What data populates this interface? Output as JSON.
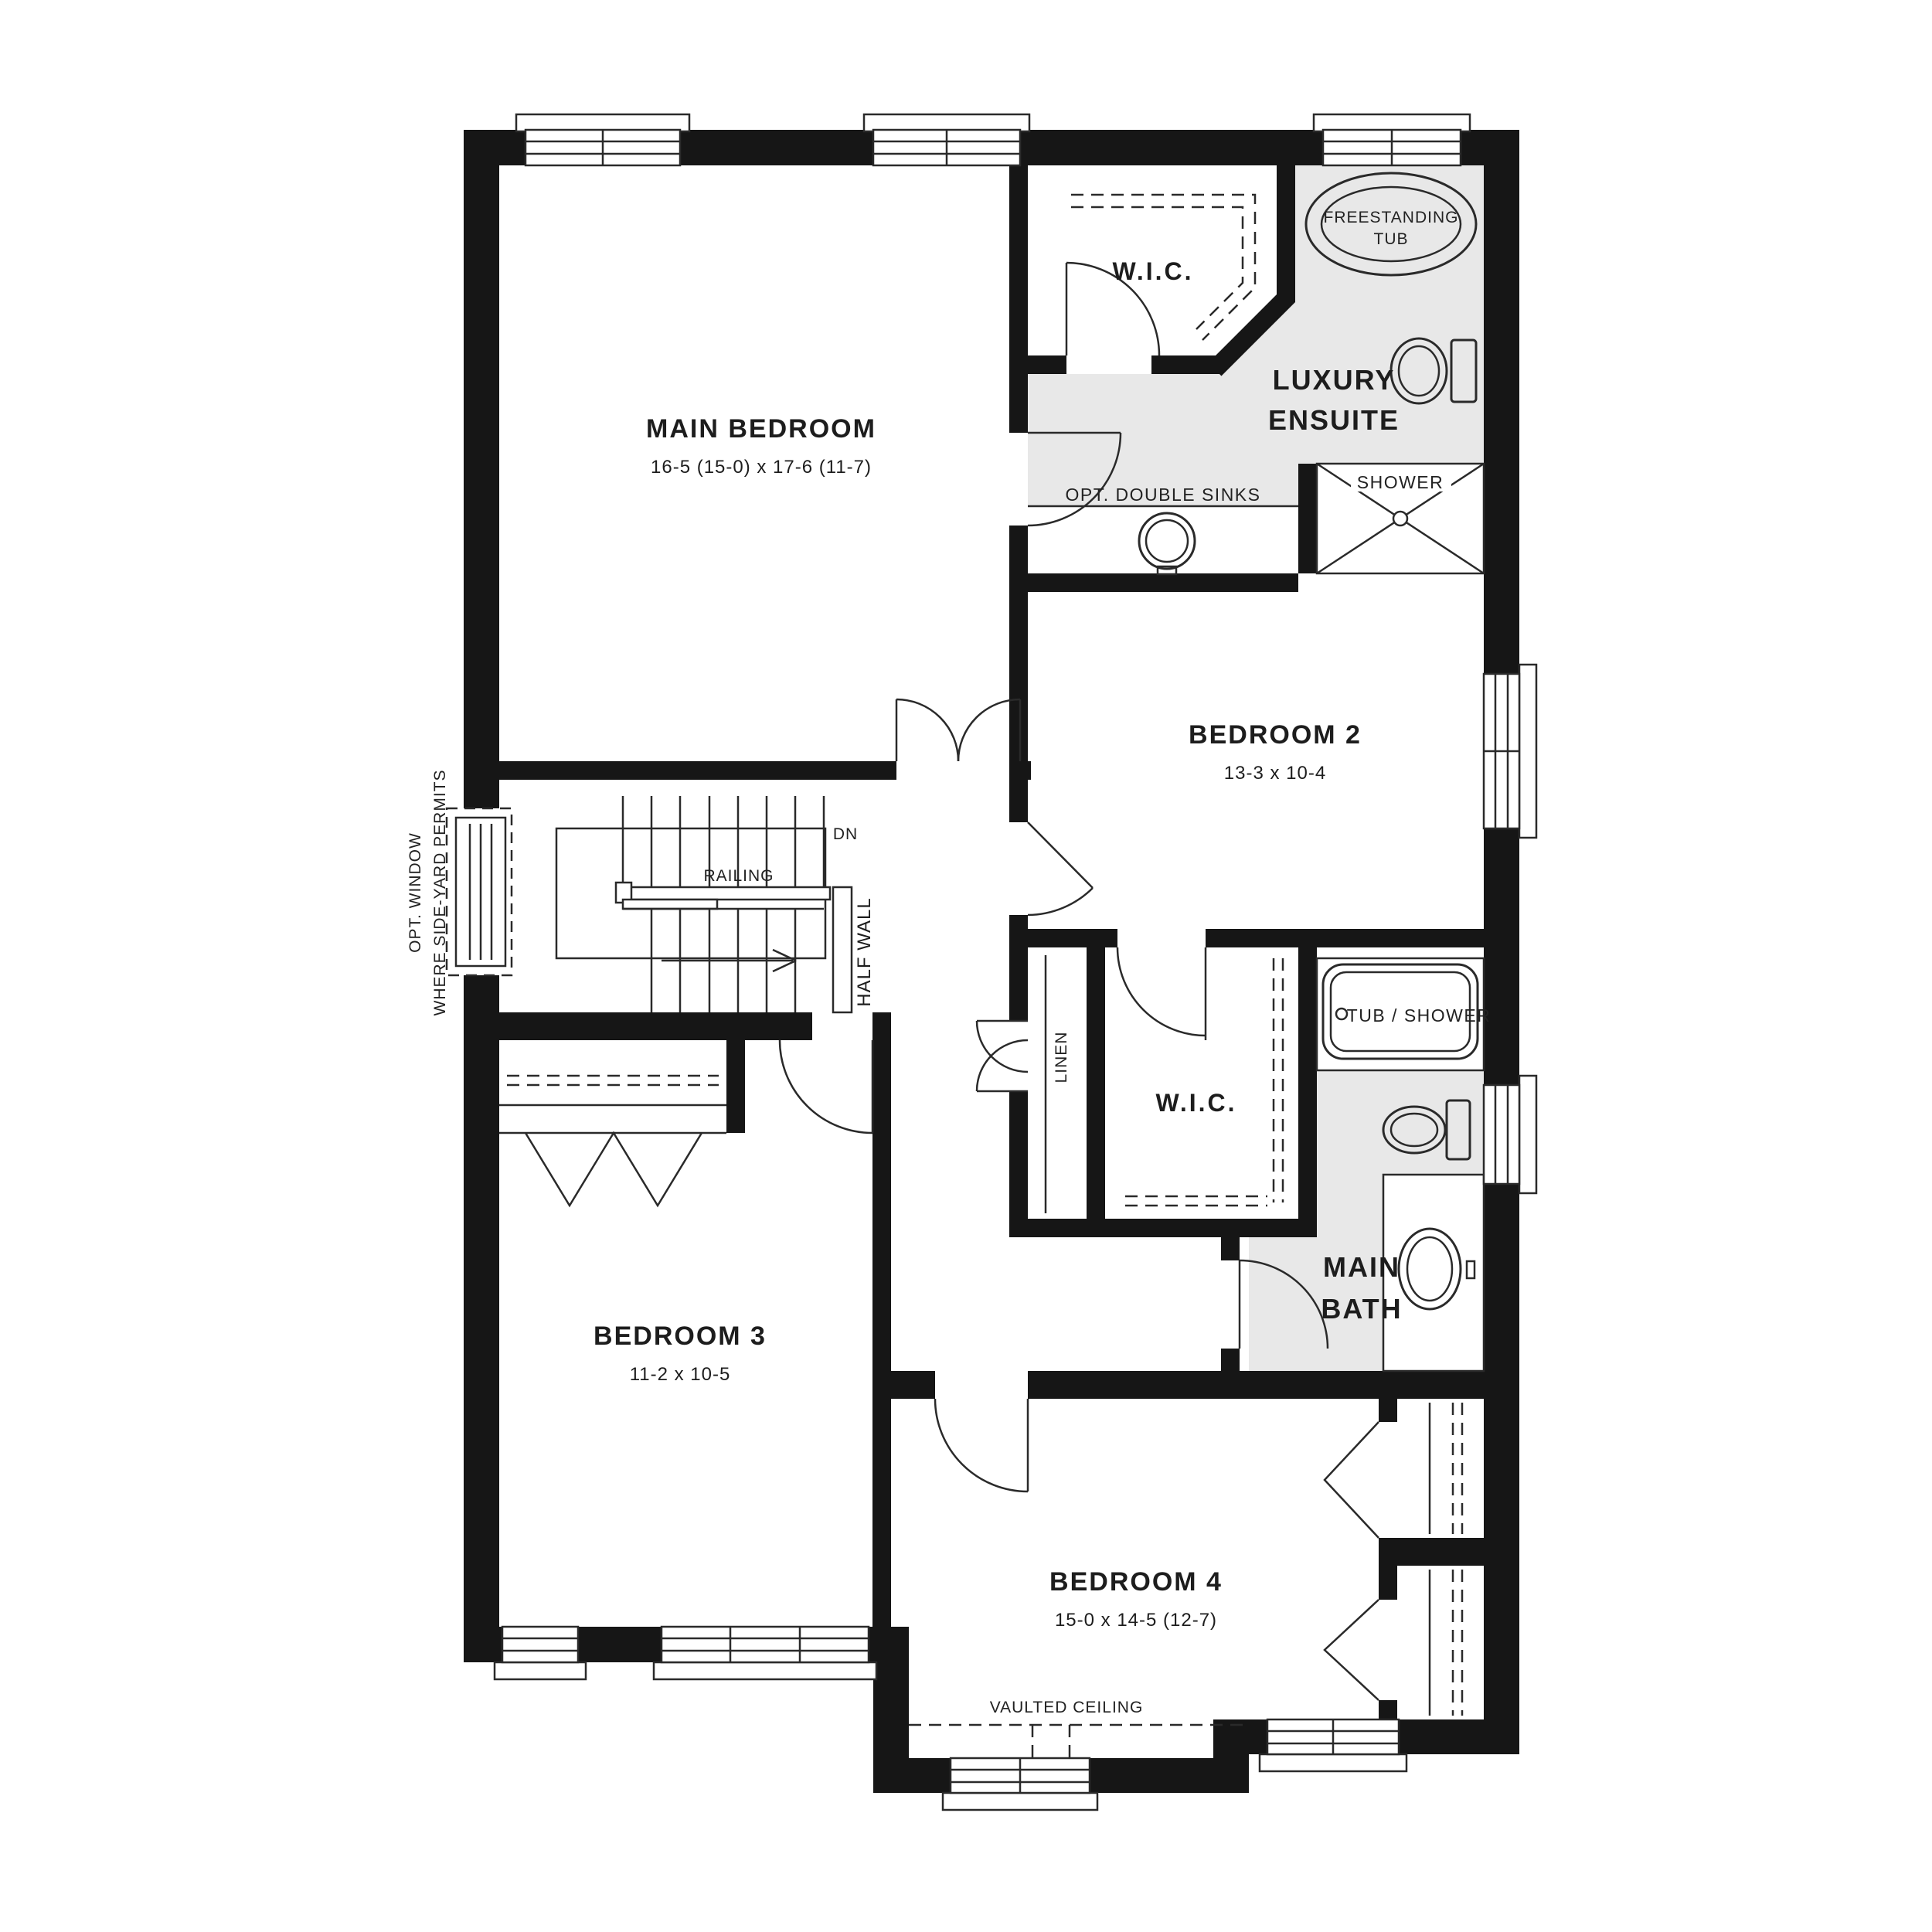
{
  "rooms": {
    "main_bedroom": {
      "name": "MAIN BEDROOM",
      "dims": "16-5 (15-0) x 17-6 (11-7)"
    },
    "wic_main": {
      "name": "W.I.C."
    },
    "luxury_ensuite": {
      "line1": "LUXURY",
      "line2": "ENSUITE"
    },
    "bedroom_2": {
      "name": "BEDROOM 2",
      "dims": "13-3 x 10-4"
    },
    "bedroom_3": {
      "name": "BEDROOM 3",
      "dims": "11-2 x 10-5"
    },
    "bedroom_4": {
      "name": "BEDROOM 4",
      "dims": "15-0 x 14-5 (12-7)"
    },
    "main_bath": {
      "line1": "MAIN",
      "line2": "BATH"
    },
    "wic_hall": {
      "name": "W.I.C."
    },
    "linen": {
      "name": "LINEN"
    }
  },
  "fixtures": {
    "freestanding_tub_line1": "FREESTANDING",
    "freestanding_tub_line2": "TUB",
    "opt_double_sinks": "OPT. DOUBLE SINKS",
    "shower": "SHOWER",
    "tub_shower": "TUB / SHOWER"
  },
  "stairs": {
    "dn": "DN",
    "railing": "RAILING",
    "half_wall": "HALF WALL"
  },
  "notes": {
    "vaulted_ceiling": "VAULTED CEILING",
    "opt_window_line1": "OPT. WINDOW",
    "opt_window_line2": "WHERE SIDE-YARD PERMITS"
  },
  "colors": {
    "wall": "#161616",
    "highlight_floor": "#e8e8e8",
    "line": "#2a2a2a",
    "background": "#ffffff"
  }
}
